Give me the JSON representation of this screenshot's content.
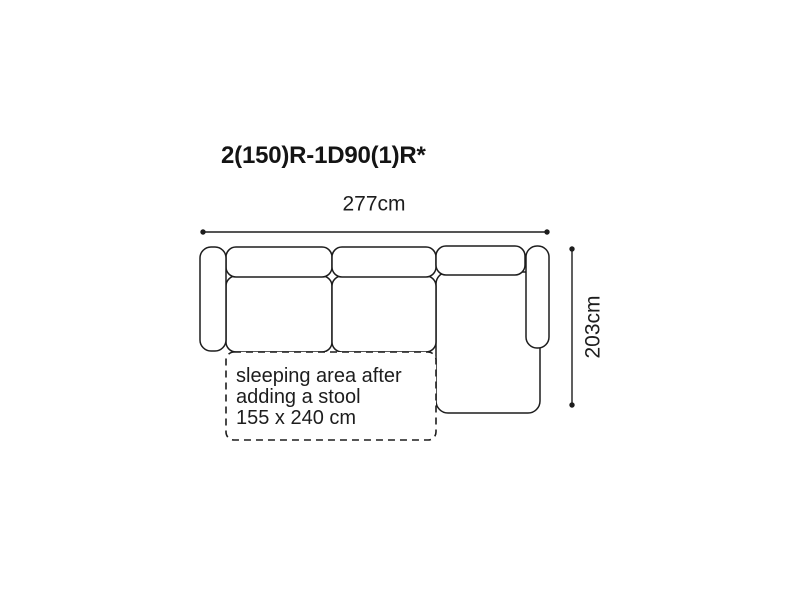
{
  "diagram": {
    "title": "2(150)R-1D90(1)R*",
    "dimensions": {
      "width_label": "277cm",
      "height_label": "203cm"
    },
    "sleeping_area_note": {
      "line1": "sleeping area after",
      "line2": "adding a stool",
      "line3": "155 x 240 cm"
    },
    "colors": {
      "line": "#1d1d1d",
      "background": "#ffffff"
    }
  }
}
